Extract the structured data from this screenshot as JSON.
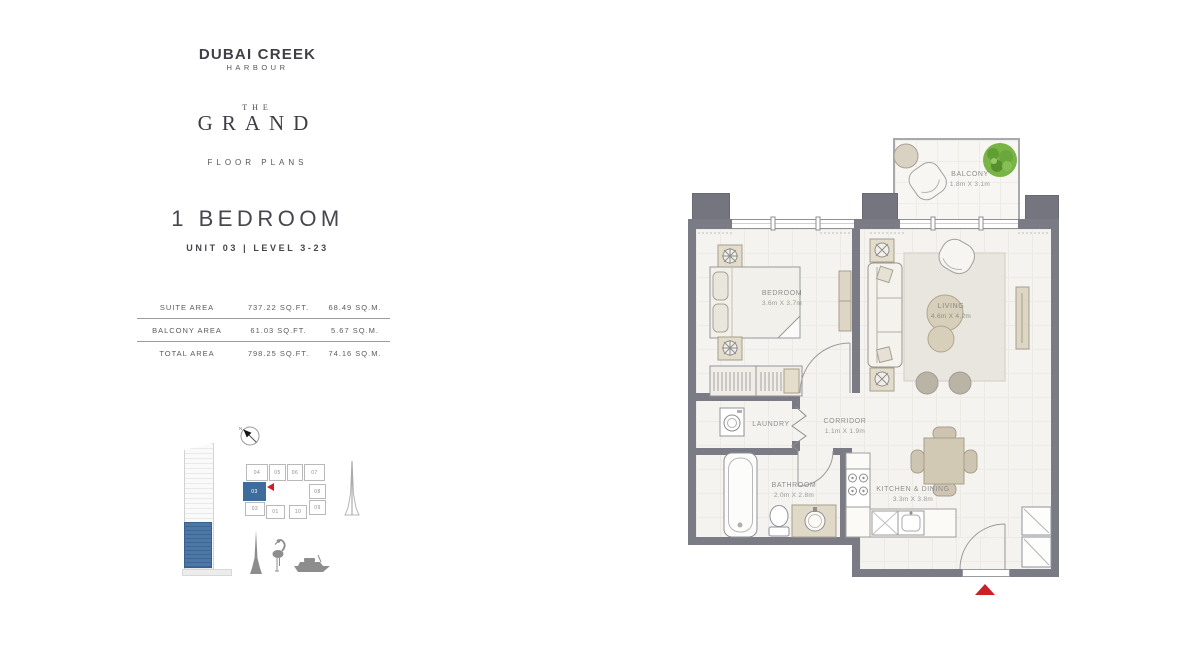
{
  "brand": {
    "name_line1": "DUBAI CREEK",
    "name_line2": "HARBOUR",
    "project_the": "THE",
    "project_name": "GRAND",
    "section_label": "FLOOR PLANS"
  },
  "unit": {
    "type_title": "1 BEDROOM",
    "subtitle": "UNIT 03 | LEVEL 3-23"
  },
  "area_table": {
    "rows": [
      {
        "label": "SUITE AREA",
        "imperial": "737.22 SQ.FT.",
        "metric": "68.49 SQ.M."
      },
      {
        "label": "BALCONY AREA",
        "imperial": "61.03 SQ.FT.",
        "metric": "5.67 SQ.M."
      },
      {
        "label": "TOTAL AREA",
        "imperial": "798.25 SQ.FT.",
        "metric": "74.16 SQ.M."
      }
    ]
  },
  "key_plan": {
    "compass_label": "N",
    "highlighted_unit": "03",
    "units": {
      "u04": "04",
      "u05": "05",
      "u06": "06",
      "u07": "07",
      "u03": "03",
      "u08": "08",
      "u02": "02",
      "u01": "01",
      "u10": "10",
      "u09": "09"
    }
  },
  "floor_plan": {
    "balcony": {
      "name": "BALCONY",
      "dims": "1.8m X 3.1m"
    },
    "bedroom": {
      "name": "BEDROOM",
      "dims": "3.6m X 3.7m"
    },
    "living": {
      "name": "LIVING",
      "dims": "4.6m X 4.2m"
    },
    "corridor": {
      "name": "CORRIDOR",
      "dims": "1.1m X 1.9m"
    },
    "laundry": {
      "name": "LAUNDRY"
    },
    "bathroom": {
      "name": "BATHROOM",
      "dims": "2.0m X 2.8m"
    },
    "kitchen": {
      "name": "KITCHEN & DINING",
      "dims": "3.3m X 3.8m"
    }
  },
  "colors": {
    "wall": "#7b7b85",
    "accent_red": "#cc2027",
    "highlight_blue": "#3e6d9d",
    "plant_green": "#79b447",
    "furniture_beige": "#d8d1c0"
  }
}
